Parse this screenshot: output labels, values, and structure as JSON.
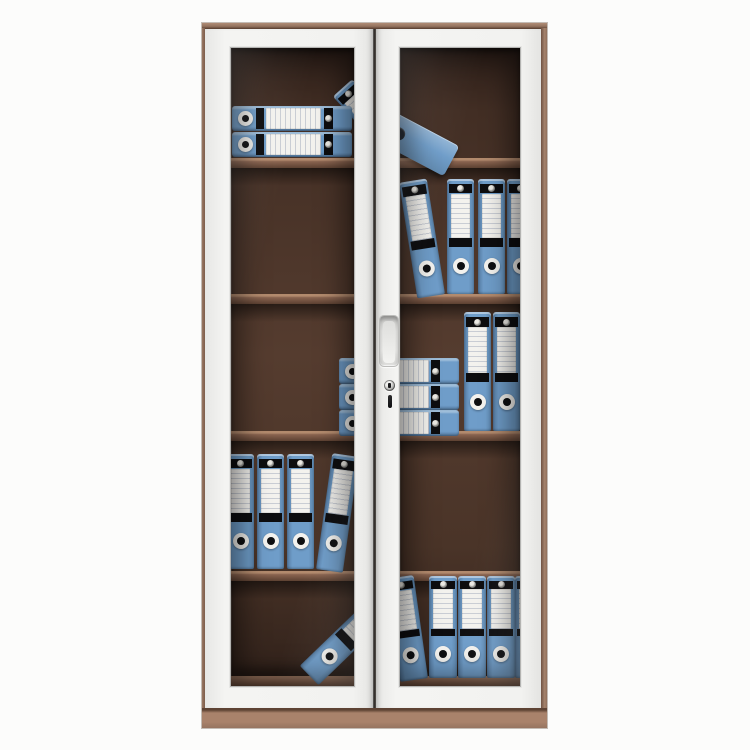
{
  "scene": {
    "type": "product-photo",
    "subject": "two-door glass-front filing cabinet with blue lever-arch binders",
    "background_color": "#fcfcfb"
  },
  "palette": {
    "blue": "#6f9dc9",
    "blue_dark": "#54799f",
    "label_white": "#f3f2ee",
    "band_black": "#0d0d0f",
    "frame_white": "#f2f2f0",
    "trim_brown": "#94735f",
    "base_brown": "#a9826b",
    "shelf_brown": "#8a6450",
    "interior_brown": "#553c2f"
  },
  "cabinet": {
    "box": {
      "x": 202,
      "y": 23,
      "w": 345,
      "h": 705
    },
    "doors": [
      {
        "name": "left-door",
        "x": 3,
        "w": 168
      },
      {
        "name": "right-door",
        "x": 174,
        "w": 165
      }
    ],
    "gap_x": 171,
    "handle": {
      "door": "right-door",
      "x": 3,
      "y": 287,
      "w": 18,
      "h": 50
    },
    "lock": {
      "door": "right-door",
      "x": 8,
      "y": 352,
      "d": 11
    },
    "panes": [
      {
        "name": "glass-pane-left",
        "door": "left-door",
        "box": {
          "x": 25,
          "y": 19,
          "w": 123,
          "h": 638
        },
        "shelves": [
          110,
          246,
          383,
          523
        ],
        "floor": 628,
        "binders": [
          {
            "kind": "v",
            "x": 132,
            "y": 27,
            "w": 26,
            "h": 100,
            "rot": -42,
            "z": 1
          },
          {
            "kind": "h",
            "x": 1,
            "y": 58,
            "w": 120,
            "h": 25,
            "z": 2
          },
          {
            "kind": "h",
            "x": 1,
            "y": 84,
            "w": 120,
            "h": 25,
            "z": 2
          },
          {
            "kind": "h",
            "x": 108,
            "y": 310,
            "w": 119,
            "h": 26
          },
          {
            "kind": "h",
            "x": 108,
            "y": 336,
            "w": 119,
            "h": 26
          },
          {
            "kind": "h",
            "x": 108,
            "y": 362,
            "w": 119,
            "h": 26
          },
          {
            "kind": "v",
            "x": -4,
            "y": 406,
            "w": 27,
            "h": 115
          },
          {
            "kind": "v",
            "x": 26,
            "y": 406,
            "w": 27,
            "h": 115
          },
          {
            "kind": "v",
            "x": 56,
            "y": 406,
            "w": 27,
            "h": 115
          },
          {
            "kind": "v",
            "x": 85,
            "y": 404,
            "w": 27,
            "h": 117,
            "rot": 8,
            "origin": "0% 100%"
          },
          {
            "kind": "v",
            "x": 106,
            "y": 530,
            "w": 27,
            "h": 115,
            "rot": 46
          }
        ]
      },
      {
        "name": "glass-pane-right",
        "door": "right-door",
        "box": {
          "x": 23,
          "y": 19,
          "w": 120,
          "h": 638
        },
        "shelves": [
          110,
          246,
          383,
          523
        ],
        "floor": 628,
        "binders": [
          {
            "kind": "slab",
            "x": -38,
            "y": 74,
            "w": 95,
            "h": 34,
            "rot": 28
          },
          {
            "kind": "v",
            "x": 17,
            "y": 129,
            "w": 28,
            "h": 117,
            "rot": -9,
            "origin": "100% 100%"
          },
          {
            "kind": "v",
            "x": 47,
            "y": 131,
            "w": 27,
            "h": 115
          },
          {
            "kind": "v",
            "x": 78,
            "y": 131,
            "w": 27,
            "h": 115
          },
          {
            "kind": "v",
            "x": 107,
            "y": 131,
            "w": 27,
            "h": 115
          },
          {
            "kind": "h",
            "x": -60,
            "y": 310,
            "w": 119,
            "h": 26
          },
          {
            "kind": "h",
            "x": -60,
            "y": 336,
            "w": 119,
            "h": 26
          },
          {
            "kind": "h",
            "x": -60,
            "y": 362,
            "w": 119,
            "h": 26
          },
          {
            "kind": "v",
            "x": 64,
            "y": 264,
            "w": 27,
            "h": 119
          },
          {
            "kind": "v",
            "x": 93,
            "y": 264,
            "w": 27,
            "h": 119
          },
          {
            "kind": "v",
            "x": 0,
            "y": 526,
            "w": 28,
            "h": 104,
            "rot": -8,
            "origin": "100% 100%"
          },
          {
            "kind": "v",
            "x": 29,
            "y": 528,
            "w": 28,
            "h": 102
          },
          {
            "kind": "v",
            "x": 58,
            "y": 528,
            "w": 28,
            "h": 102
          },
          {
            "kind": "v",
            "x": 87,
            "y": 528,
            "w": 28,
            "h": 102
          },
          {
            "kind": "v",
            "x": 115,
            "y": 528,
            "w": 28,
            "h": 102
          }
        ]
      }
    ]
  }
}
